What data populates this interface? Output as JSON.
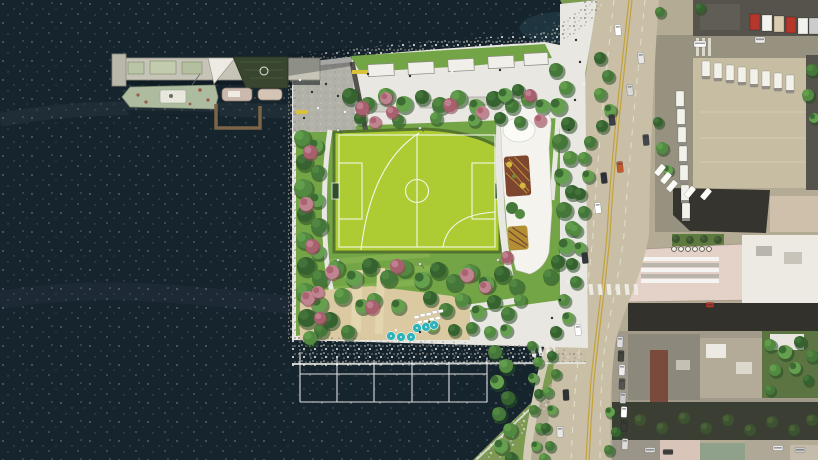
{
  "meta": {
    "title": "Aerial rendering: waterfront peninsula park with sports field, pier with historic ship, beach, greenway and West Side Highway beside city blocks",
    "view": "top-down aerial / site plan",
    "visible_text": "none"
  },
  "colors": {
    "water": "#16242e",
    "sparkle": "#cfd8dc",
    "shallow": "#2e555e",
    "rock": "#b5b3aa",
    "rockDot": "#908e86",
    "rockLight": "#d2d1c9",
    "foam": "#e6e8e2",
    "path": "#e8e7e1",
    "plaza": "#b2b1a8",
    "concrete": "#cdccc4",
    "lawn": "#73a546",
    "lawnLight": "#8ab653",
    "gwGreen": "#7c9a50",
    "field": "#adcb32",
    "fieldLine": "#f4f7ea",
    "fieldEdge": "#55752f",
    "sand": "#dbc9a1",
    "boardwalk": "#e3d5ae",
    "treeDark": "#274d26",
    "tree1": "#35622f",
    "tree2": "#447739",
    "tree3": "#538a42",
    "tree4": "#65a04e",
    "treeOlive": "#3d5230",
    "pink1": "#a85f6e",
    "pink2": "#c08490",
    "pink3": "#8c4b59",
    "highway": "#c8bfa6",
    "laneYellow": "#c3a23a",
    "laneWhite": "#eae6d8",
    "street": "#97917f",
    "streetDark": "#32312c",
    "sidewalk": "#b6afa0",
    "cityBase": "#b3ab94",
    "lot": "#c6bda2",
    "roofDark": "#55534b",
    "roofBlack": "#35342f",
    "roofPink": "#e4d1c7",
    "roofWhite": "#eceae2",
    "roofTan": "#b3aa98",
    "roofGray": "#8d887c",
    "roofBrown": "#7a4a3c",
    "courtyard": "#5c7442",
    "bandDark": "#3a3e33",
    "pierDeck": "#c6c4b7",
    "pierEdge": "#8b8a7e",
    "shed": "#39462f",
    "shipHull": "#adbb9e",
    "shipTrim": "#e7e7dd",
    "rust": "#9c5848",
    "dockBrown": "#7c6547",
    "boat": "#cbb9ad",
    "bldgWhite": "#f4f3ee",
    "roofGarden": "#7e452f",
    "gardenYellow": "#d2b83f",
    "umbrella": "#2fb3b8",
    "white": "#ffffff",
    "personDark": "#2f2e2a"
  },
  "features": {
    "water_label": "river water with whitecap sparkle",
    "peninsula_label": "park peninsula with sports field, lawns, beach and tree groves",
    "pier_label": "north pier with dark-green shed building and docked historic ship plus two small boats and L-shaped floating dock",
    "field_label": "bright green turf field with white soccer and ball-field markings, two goals",
    "building_label": "white park building east of field with round roof and two planted roof-garden patches",
    "beach_label": "sandy cove beach with 6 teal umbrellas and white loungers",
    "grid_label": "white surveyed pile-field grid outline in the water south of the beach",
    "greenway_label": "tree-lined bikeway between park and highway with pedestrian crosswalks",
    "highway_label": "multi-lane highway with double yellow lines, dashed white lanes and traffic",
    "city_label": "city blocks: truck parking lot, dark roofs, pink sawtooth-roof market building, dense rooftops and green courtyards"
  },
  "counts": {
    "beach_umbrellas": 6,
    "survey_grid_cells": 5,
    "roof_vents": 6
  },
  "scene": {
    "trees": [
      [
        350,
        96,
        8
      ],
      [
        368,
        104,
        7
      ],
      [
        386,
        96,
        8
      ],
      [
        404,
        104,
        8
      ],
      [
        422,
        97,
        7
      ],
      [
        440,
        105,
        8
      ],
      [
        458,
        98,
        8
      ],
      [
        476,
        106,
        7
      ],
      [
        494,
        99,
        8
      ],
      [
        512,
        106,
        7
      ],
      [
        528,
        99,
        7
      ],
      [
        542,
        106,
        7
      ],
      [
        360,
        118,
        6
      ],
      [
        398,
        120,
        6
      ],
      [
        436,
        118,
        6
      ],
      [
        474,
        120,
        6
      ],
      [
        500,
        118,
        6
      ],
      [
        520,
        122,
        6
      ],
      [
        302,
        138,
        8
      ],
      [
        316,
        146,
        7
      ],
      [
        304,
        162,
        8
      ],
      [
        318,
        172,
        7
      ],
      [
        303,
        188,
        9
      ],
      [
        317,
        200,
        7
      ],
      [
        305,
        214,
        8
      ],
      [
        319,
        226,
        8
      ],
      [
        304,
        240,
        8
      ],
      [
        318,
        252,
        7
      ],
      [
        306,
        266,
        9
      ],
      [
        320,
        278,
        8
      ],
      [
        305,
        292,
        9
      ],
      [
        319,
        304,
        8
      ],
      [
        307,
        318,
        9
      ],
      [
        321,
        330,
        7
      ],
      [
        310,
        338,
        7
      ],
      [
        505,
        95,
        7
      ],
      [
        518,
        90,
        6
      ],
      [
        556,
        70,
        7
      ],
      [
        566,
        88,
        7
      ],
      [
        558,
        106,
        8
      ],
      [
        568,
        124,
        7
      ],
      [
        560,
        142,
        8
      ],
      [
        570,
        158,
        7
      ],
      [
        562,
        176,
        8
      ],
      [
        572,
        192,
        7
      ],
      [
        564,
        210,
        8
      ],
      [
        572,
        228,
        7
      ],
      [
        566,
        246,
        8
      ],
      [
        558,
        262,
        7
      ],
      [
        550,
        276,
        7
      ],
      [
        336,
        268,
        8
      ],
      [
        354,
        278,
        8
      ],
      [
        370,
        266,
        8
      ],
      [
        388,
        278,
        8
      ],
      [
        404,
        268,
        8
      ],
      [
        422,
        280,
        8
      ],
      [
        438,
        270,
        8
      ],
      [
        454,
        282,
        8
      ],
      [
        470,
        272,
        8
      ],
      [
        486,
        284,
        8
      ],
      [
        502,
        274,
        8
      ],
      [
        516,
        286,
        7
      ],
      [
        342,
        296,
        8
      ],
      [
        362,
        306,
        7
      ],
      [
        330,
        320,
        8
      ],
      [
        348,
        332,
        7
      ],
      [
        374,
        300,
        7
      ],
      [
        398,
        306,
        7
      ],
      [
        430,
        298,
        7
      ],
      [
        446,
        310,
        7
      ],
      [
        462,
        300,
        7
      ],
      [
        478,
        312,
        7
      ],
      [
        494,
        302,
        7
      ],
      [
        508,
        314,
        7
      ],
      [
        520,
        300,
        6
      ],
      [
        432,
        326,
        6
      ],
      [
        454,
        330,
        6
      ],
      [
        472,
        328,
        6
      ],
      [
        490,
        332,
        6
      ],
      [
        506,
        330,
        6
      ],
      [
        600,
        58,
        6
      ],
      [
        608,
        76,
        6
      ],
      [
        600,
        94,
        6
      ],
      [
        610,
        110,
        6
      ],
      [
        602,
        126,
        6
      ],
      [
        590,
        142,
        6
      ],
      [
        584,
        158,
        6
      ],
      [
        588,
        176,
        6
      ],
      [
        580,
        194,
        6
      ],
      [
        584,
        212,
        6
      ],
      [
        576,
        230,
        6
      ],
      [
        580,
        248,
        6
      ],
      [
        572,
        264,
        6
      ],
      [
        576,
        282,
        6
      ],
      [
        564,
        300,
        6
      ],
      [
        568,
        318,
        6
      ],
      [
        556,
        332,
        6
      ],
      [
        495,
        352,
        7
      ],
      [
        506,
        366,
        7
      ],
      [
        497,
        382,
        7
      ],
      [
        508,
        398,
        7
      ],
      [
        499,
        414,
        7
      ],
      [
        510,
        430,
        7
      ],
      [
        501,
        446,
        7
      ],
      [
        511,
        458,
        6
      ],
      [
        532,
        346,
        5
      ],
      [
        538,
        362,
        5
      ],
      [
        533,
        378,
        5
      ],
      [
        539,
        394,
        5
      ],
      [
        534,
        410,
        5
      ],
      [
        540,
        428,
        5
      ],
      [
        536,
        446,
        5
      ],
      [
        552,
        356,
        5
      ],
      [
        556,
        374,
        5
      ],
      [
        548,
        392,
        5
      ],
      [
        552,
        410,
        5
      ],
      [
        546,
        428,
        5
      ],
      [
        550,
        446,
        5
      ],
      [
        544,
        458,
        5
      ],
      [
        610,
        412,
        5
      ],
      [
        616,
        432,
        5
      ],
      [
        609,
        450,
        5
      ],
      [
        662,
        148,
        6
      ],
      [
        668,
        170,
        5
      ],
      [
        658,
        122,
        5
      ],
      [
        812,
        70,
        6
      ],
      [
        808,
        95,
        6
      ],
      [
        814,
        118,
        5
      ],
      [
        700,
        8,
        5
      ],
      [
        660,
        12,
        5
      ],
      [
        770,
        345,
        6
      ],
      [
        785,
        352,
        7
      ],
      [
        800,
        342,
        6
      ],
      [
        812,
        356,
        6
      ],
      [
        775,
        370,
        6
      ],
      [
        795,
        368,
        6
      ],
      [
        808,
        380,
        5
      ],
      [
        770,
        390,
        5
      ]
    ],
    "pinkTrees": [
      [
        362,
        108,
        7
      ],
      [
        375,
        122,
        6
      ],
      [
        392,
        112,
        6
      ],
      [
        386,
        98,
        6
      ],
      [
        450,
        105,
        7
      ],
      [
        482,
        112,
        6
      ],
      [
        530,
        95,
        6
      ],
      [
        540,
        120,
        6
      ],
      [
        310,
        152,
        7
      ],
      [
        306,
        204,
        7
      ],
      [
        312,
        246,
        7
      ],
      [
        308,
        298,
        7
      ],
      [
        320,
        318,
        6
      ],
      [
        332,
        272,
        7
      ],
      [
        397,
        266,
        7
      ],
      [
        467,
        275,
        7
      ],
      [
        507,
        257,
        6
      ],
      [
        485,
        287,
        6
      ],
      [
        372,
        307,
        7
      ],
      [
        318,
        292,
        6
      ]
    ],
    "oliveTrees": [
      [
        640,
        420,
        6
      ],
      [
        662,
        428,
        6
      ],
      [
        684,
        418,
        6
      ],
      [
        706,
        428,
        6
      ],
      [
        728,
        420,
        6
      ],
      [
        750,
        430,
        6
      ],
      [
        772,
        422,
        6
      ],
      [
        794,
        430,
        6
      ],
      [
        812,
        420,
        6
      ],
      [
        676,
        239,
        4
      ],
      [
        690,
        240,
        4
      ],
      [
        704,
        239,
        4
      ],
      [
        718,
        240,
        4
      ]
    ],
    "umbrellas": [
      [
        391,
        336
      ],
      [
        401,
        337
      ],
      [
        411,
        337
      ],
      [
        417,
        328
      ],
      [
        426,
        327
      ],
      [
        434,
        325
      ]
    ],
    "loungers": [
      [
        414,
        316
      ],
      [
        420,
        314
      ],
      [
        426,
        313
      ],
      [
        432,
        311
      ],
      [
        438,
        310
      ],
      [
        417,
        321
      ],
      [
        423,
        320
      ],
      [
        429,
        318
      ],
      [
        435,
        317
      ]
    ],
    "people": [
      [
        572,
        18
      ],
      [
        576,
        40
      ],
      [
        580,
        62
      ],
      [
        584,
        84
      ],
      [
        575,
        100
      ],
      [
        569,
        130
      ],
      [
        300,
        80
      ],
      [
        312,
        92
      ],
      [
        326,
        84
      ],
      [
        318,
        108
      ],
      [
        304,
        118
      ],
      [
        338,
        96
      ],
      [
        345,
        112
      ],
      [
        368,
        74
      ],
      [
        410,
        76
      ],
      [
        452,
        72
      ],
      [
        500,
        70
      ],
      [
        560,
        300
      ],
      [
        568,
        282
      ],
      [
        552,
        318
      ],
      [
        420,
        332
      ],
      [
        396,
        330
      ],
      [
        340,
        350
      ],
      [
        300,
        355
      ]
    ],
    "lightposts": [
      [
        338,
        130
      ],
      [
        338,
        260
      ],
      [
        420,
        264
      ],
      [
        498,
        260
      ],
      [
        420,
        128
      ]
    ],
    "cars": [
      [
        618,
        30,
        6,
        11,
        -4,
        "#ffffff"
      ],
      [
        641,
        58,
        6,
        11,
        -4,
        "#e8e8e8"
      ],
      [
        630,
        90,
        6,
        11,
        -5,
        "#d9d9d9"
      ],
      [
        646,
        140,
        6,
        11,
        -5,
        "#45494e"
      ],
      [
        612,
        120,
        6,
        11,
        -6,
        "#3a3f45"
      ],
      [
        620,
        167,
        6,
        11,
        -6,
        "#c25a2e"
      ],
      [
        604,
        178,
        6,
        11,
        -6,
        "#2e3237"
      ],
      [
        598,
        208,
        6,
        11,
        -6,
        "#ffffff"
      ],
      [
        585,
        258,
        6,
        11,
        -6,
        "#33373c"
      ],
      [
        578,
        330,
        6,
        11,
        -4,
        "#ffffff"
      ],
      [
        566,
        395,
        6,
        11,
        -3,
        "#2f3338"
      ],
      [
        560,
        432,
        6,
        11,
        -2,
        "#e8e8e8"
      ],
      [
        620,
        342,
        6,
        11,
        2,
        "#dddddd"
      ],
      [
        621,
        356,
        6,
        11,
        2,
        "#44443f"
      ],
      [
        622,
        370,
        6,
        11,
        2,
        "#eeeeee"
      ],
      [
        622,
        384,
        6,
        11,
        2,
        "#555550"
      ],
      [
        623,
        398,
        6,
        11,
        2,
        "#cccccc"
      ],
      [
        624,
        412,
        6,
        11,
        2,
        "#ffffff"
      ],
      [
        624,
        426,
        6,
        11,
        2,
        "#3a3a36"
      ],
      [
        625,
        444,
        6,
        11,
        2,
        "#dddddd"
      ],
      [
        700,
        44,
        12,
        6,
        0,
        "#ffffff"
      ],
      [
        760,
        40,
        10,
        6,
        0,
        "#e8e8e8"
      ],
      [
        710,
        305,
        8,
        5,
        0,
        "#b5372c"
      ],
      [
        650,
        450,
        10,
        5,
        0,
        "#dddddd"
      ],
      [
        668,
        452,
        10,
        5,
        0,
        "#44443f"
      ],
      [
        778,
        448,
        10,
        5,
        0,
        "#eeeeee"
      ],
      [
        800,
        450,
        10,
        5,
        0,
        "#cccccc"
      ]
    ],
    "trucks": [
      [
        706,
        70
      ],
      [
        718,
        72
      ],
      [
        730,
        74
      ],
      [
        742,
        76
      ],
      [
        754,
        78
      ],
      [
        766,
        80
      ],
      [
        778,
        82
      ],
      [
        790,
        84
      ],
      [
        680,
        100
      ],
      [
        681,
        118
      ],
      [
        682,
        136
      ],
      [
        683,
        155
      ],
      [
        684,
        174
      ],
      [
        685,
        194
      ],
      [
        686,
        212
      ]
    ],
    "vans": [
      [
        660,
        170
      ],
      [
        666,
        178
      ],
      [
        672,
        186
      ],
      [
        690,
        192
      ],
      [
        706,
        194
      ]
    ],
    "trailers": [
      [
        750,
        14,
        "#b5372c"
      ],
      [
        762,
        15,
        "#f2f2ee"
      ],
      [
        774,
        16,
        "#d9cdb0"
      ],
      [
        786,
        17,
        "#b5372c"
      ],
      [
        798,
        18,
        "#f2f2ee"
      ],
      [
        809,
        18,
        "#cccccc"
      ]
    ]
  }
}
